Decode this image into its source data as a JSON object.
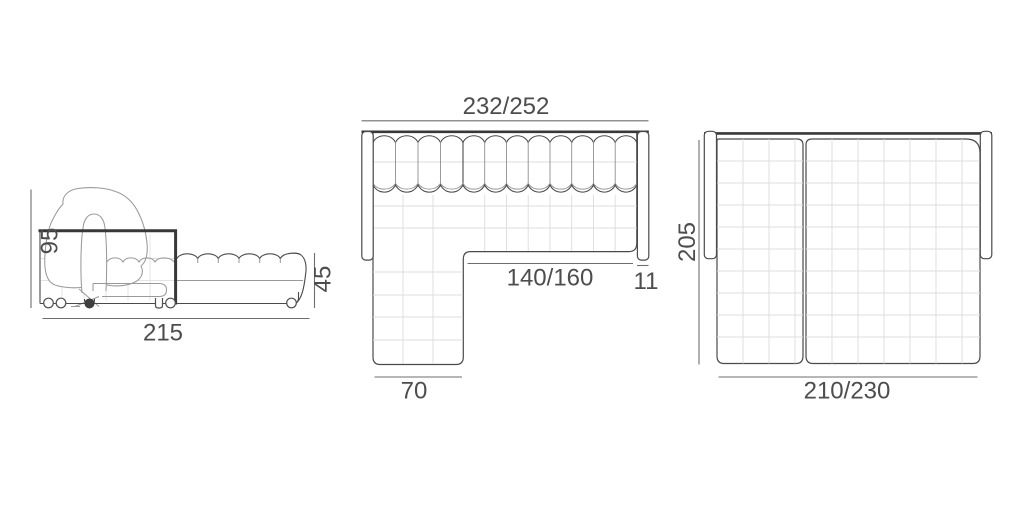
{
  "diagram_title": "sofa-bed technical dimension drawing",
  "colors": {
    "background": "#ffffff",
    "outline": "#4a4a4a",
    "thick_edge": "#383838",
    "soft_detail": "#9a9a9a",
    "grid": "#dcdcdc",
    "dimension_line": "#6e6e6e",
    "label_text": "#4d4d4d"
  },
  "views": {
    "side": {
      "height_label": "95",
      "length_label": "215",
      "seat_height_label": "45"
    },
    "corner_top": {
      "width_label": "232/252",
      "seat_width_label": "140/160",
      "armrest_label": "11",
      "chaise_width_label": "70"
    },
    "bed_top": {
      "depth_label": "205",
      "width_label": "210/230"
    }
  }
}
